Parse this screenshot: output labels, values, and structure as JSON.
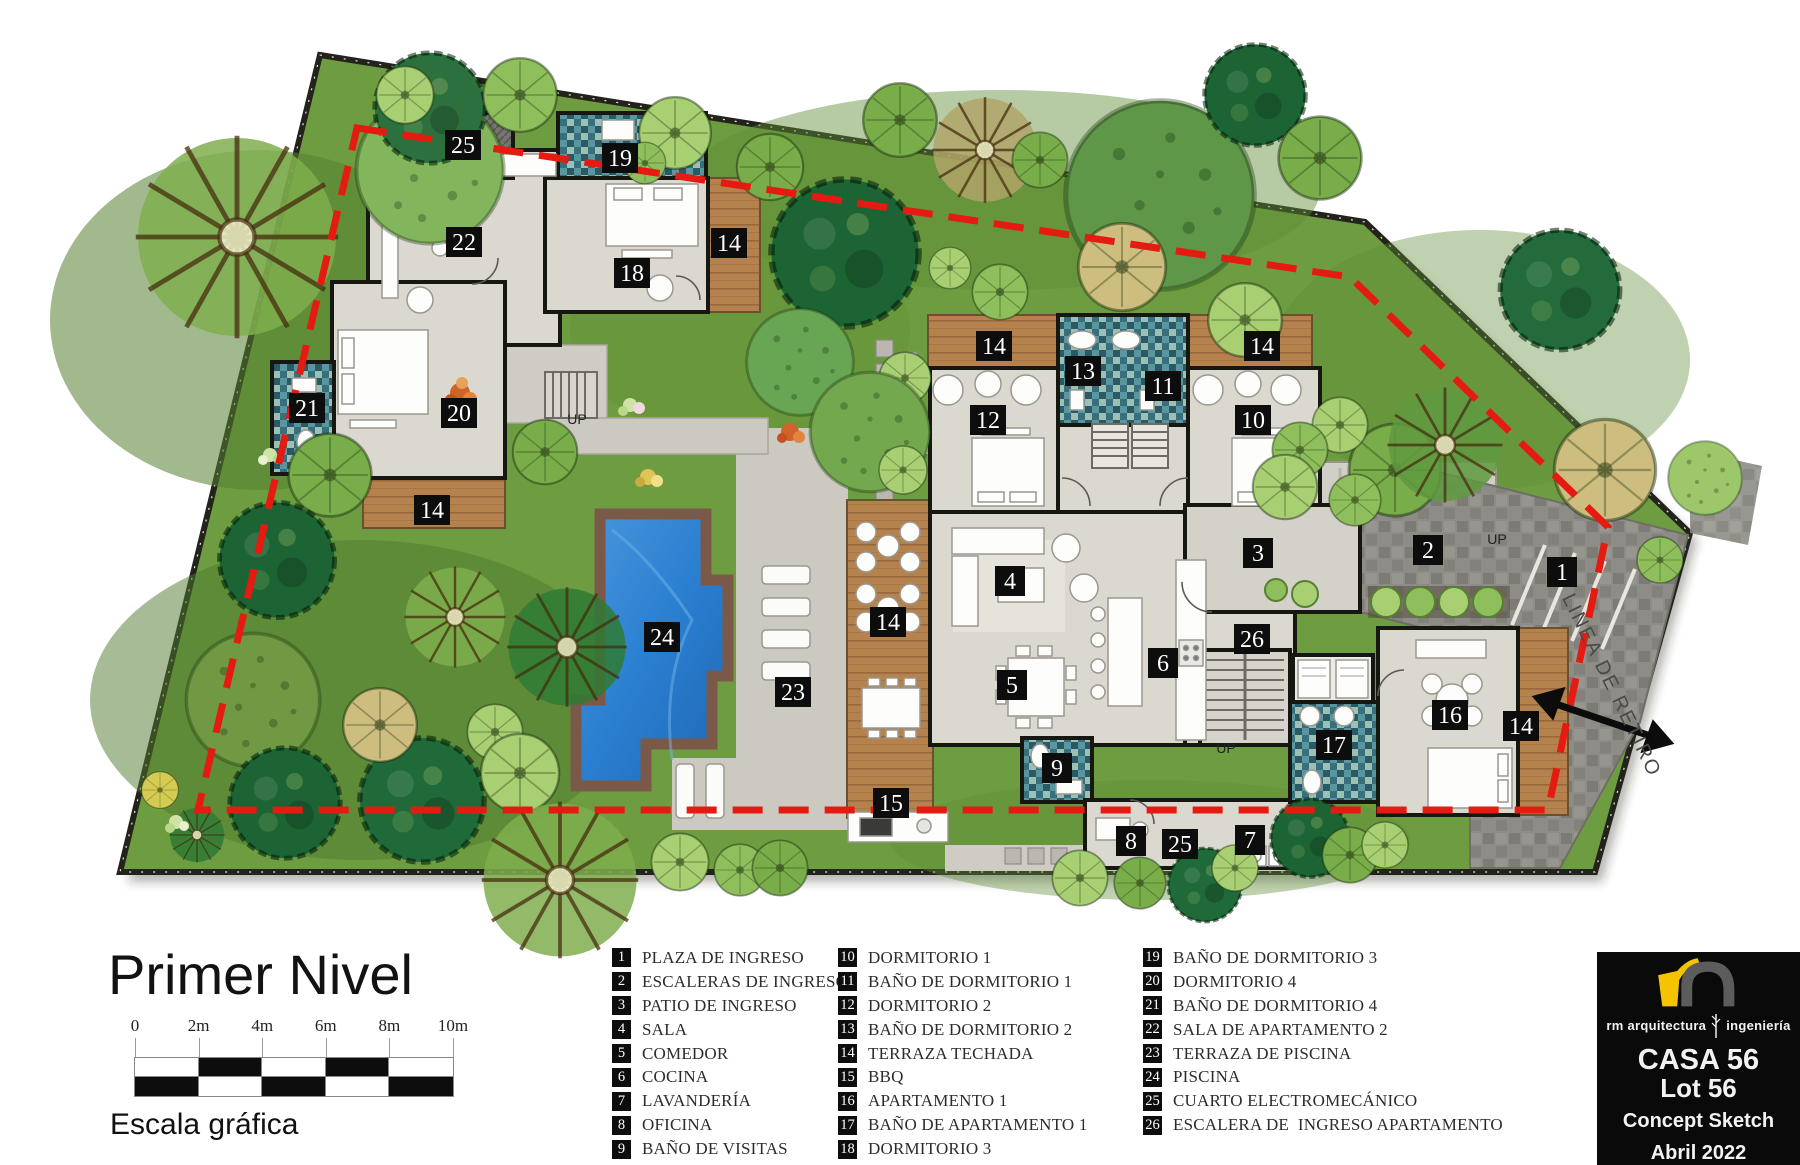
{
  "plan": {
    "title": "Primer Nivel",
    "scale_bar": {
      "labels": [
        "0",
        "2m",
        "4m",
        "6m",
        "8m",
        "10m"
      ],
      "caption": "Escala gráfica"
    },
    "badges": [
      {
        "n": "1",
        "x": 1562,
        "y": 572
      },
      {
        "n": "2",
        "x": 1428,
        "y": 550
      },
      {
        "n": "3",
        "x": 1258,
        "y": 553
      },
      {
        "n": "4",
        "x": 1010,
        "y": 581
      },
      {
        "n": "5",
        "x": 1012,
        "y": 685
      },
      {
        "n": "6",
        "x": 1163,
        "y": 663
      },
      {
        "n": "7",
        "x": 1250,
        "y": 840
      },
      {
        "n": "8",
        "x": 1131,
        "y": 841
      },
      {
        "n": "9",
        "x": 1057,
        "y": 768
      },
      {
        "n": "10",
        "x": 1253,
        "y": 420
      },
      {
        "n": "11",
        "x": 1163,
        "y": 386
      },
      {
        "n": "12",
        "x": 988,
        "y": 420
      },
      {
        "n": "13",
        "x": 1083,
        "y": 371
      },
      {
        "n": "14",
        "x": 729,
        "y": 243
      },
      {
        "n": "14",
        "x": 432,
        "y": 510
      },
      {
        "n": "14",
        "x": 888,
        "y": 622
      },
      {
        "n": "14",
        "x": 994,
        "y": 346
      },
      {
        "n": "14",
        "x": 1262,
        "y": 346
      },
      {
        "n": "14",
        "x": 1521,
        "y": 726
      },
      {
        "n": "15",
        "x": 891,
        "y": 803
      },
      {
        "n": "16",
        "x": 1450,
        "y": 715
      },
      {
        "n": "17",
        "x": 1334,
        "y": 745
      },
      {
        "n": "18",
        "x": 632,
        "y": 273
      },
      {
        "n": "19",
        "x": 620,
        "y": 158
      },
      {
        "n": "20",
        "x": 459,
        "y": 413
      },
      {
        "n": "21",
        "x": 307,
        "y": 408
      },
      {
        "n": "22",
        "x": 464,
        "y": 242
      },
      {
        "n": "23",
        "x": 793,
        "y": 692
      },
      {
        "n": "24",
        "x": 662,
        "y": 637
      },
      {
        "n": "25",
        "x": 463,
        "y": 145
      },
      {
        "n": "25",
        "x": 1180,
        "y": 844
      },
      {
        "n": "26",
        "x": 1252,
        "y": 639
      }
    ],
    "annotations": [
      {
        "text": "UP",
        "x": 577,
        "y": 424,
        "rotate": 0,
        "size": 14
      },
      {
        "text": "UP",
        "x": 1497,
        "y": 544,
        "rotate": 0,
        "size": 14
      },
      {
        "text": "UP",
        "x": 1226,
        "y": 753,
        "rotate": 0,
        "size": 14
      },
      {
        "text": "LINEA DE RETIRO",
        "x": 1606,
        "y": 688,
        "rotate": 64,
        "size": 20
      }
    ]
  },
  "legend": {
    "columns": [
      [
        {
          "n": "1",
          "label": "PLAZA DE INGRESO"
        },
        {
          "n": "2",
          "label": "ESCALERAS DE INGRESO"
        },
        {
          "n": "3",
          "label": "PATIO DE INGRESO"
        },
        {
          "n": "4",
          "label": "SALA"
        },
        {
          "n": "5",
          "label": "COMEDOR"
        },
        {
          "n": "6",
          "label": "COCINA"
        },
        {
          "n": "7",
          "label": "LAVANDERÍA"
        },
        {
          "n": "8",
          "label": "OFICINA"
        },
        {
          "n": "9",
          "label": "BAÑO DE VISITAS"
        }
      ],
      [
        {
          "n": "10",
          "label": "DORMITORIO 1"
        },
        {
          "n": "11",
          "label": "BAÑO DE DORMITORIO 1"
        },
        {
          "n": "12",
          "label": "DORMITORIO 2"
        },
        {
          "n": "13",
          "label": "BAÑO DE DORMITORIO 2"
        },
        {
          "n": "14",
          "label": "TERRAZA TECHADA"
        },
        {
          "n": "15",
          "label": "BBQ"
        },
        {
          "n": "16",
          "label": "APARTAMENTO 1"
        },
        {
          "n": "17",
          "label": "BAÑO DE APARTAMENTO 1"
        },
        {
          "n": "18",
          "label": "DORMITORIO 3"
        }
      ],
      [
        {
          "n": "19",
          "label": "BAÑO DE DORMITORIO 3"
        },
        {
          "n": "20",
          "label": "DORMITORIO 4"
        },
        {
          "n": "21",
          "label": "BAÑO DE DORMITORIO 4"
        },
        {
          "n": "22",
          "label": "SALA DE APARTAMENTO 2"
        },
        {
          "n": "23",
          "label": "TERRAZA DE PISCINA"
        },
        {
          "n": "24",
          "label": "PISCINA"
        },
        {
          "n": "25",
          "label": "CUARTO ELECTROMECÁNICO"
        },
        {
          "n": "26",
          "label": "ESCALERA DE  INGRESO APARTAMENTO"
        }
      ]
    ]
  },
  "title_block": {
    "firm_left": "rm arquitectura",
    "firm_right": "ingeniería",
    "project": "CASA 56",
    "lot": "Lot 56",
    "phase": "Concept Sketch",
    "date": "Abril 2022",
    "accent_color": "#f5c400",
    "panel_color": "#0a0a0a"
  },
  "colors": {
    "lawn": "#6d9d40",
    "pool": "#2a7fd0",
    "wood_deck": "#b5824e",
    "stone_deck": "#ccc9c1",
    "setback_line": "#e51b12",
    "badge": "#0d0d0d"
  }
}
